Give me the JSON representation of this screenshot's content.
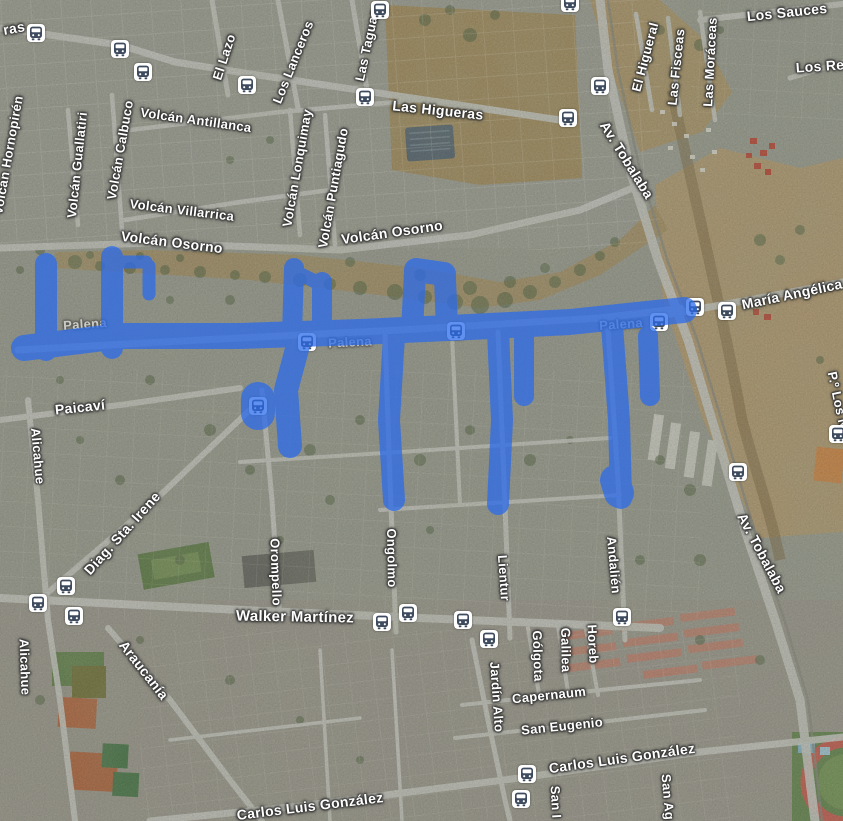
{
  "map": {
    "type": "satellite",
    "colors": {
      "route_overlay": "#2b6bec",
      "label_text": "#ffffff",
      "bus_icon_glyph": "#3e4b5e",
      "bus_icon_background": "#ffffff"
    },
    "street_labels": [
      {
        "text": "ras",
        "x": 14,
        "y": 28,
        "rot": -10,
        "size": 14,
        "faint": false
      },
      {
        "text": "El Lazo",
        "x": 224,
        "y": 57,
        "rot": -72,
        "size": 13,
        "faint": false
      },
      {
        "text": "Los Lanceros",
        "x": 293,
        "y": 62,
        "rot": -68,
        "size": 13,
        "faint": false
      },
      {
        "text": "Las Taguas",
        "x": 367,
        "y": 45,
        "rot": -78,
        "size": 13,
        "faint": false
      },
      {
        "text": "Las Higueras",
        "x": 438,
        "y": 110,
        "rot": 6,
        "size": 14,
        "faint": false
      },
      {
        "text": "Los Sauces",
        "x": 787,
        "y": 12,
        "rot": -6,
        "size": 14,
        "faint": false
      },
      {
        "text": "El Higueral",
        "x": 645,
        "y": 57,
        "rot": -75,
        "size": 13,
        "faint": false
      },
      {
        "text": "Las Fisceas",
        "x": 676,
        "y": 67,
        "rot": -84,
        "size": 13,
        "faint": false
      },
      {
        "text": "Las Moráceas",
        "x": 710,
        "y": 62,
        "rot": -87,
        "size": 13,
        "faint": false
      },
      {
        "text": "Los Re",
        "x": 820,
        "y": 66,
        "rot": -4,
        "size": 14,
        "faint": false
      },
      {
        "text": "Volcán Antillanca",
        "x": 196,
        "y": 120,
        "rot": 8,
        "size": 13,
        "faint": false
      },
      {
        "text": "Volcán Hornopirén",
        "x": 8,
        "y": 155,
        "rot": -80,
        "size": 13,
        "faint": false
      },
      {
        "text": "Volcán Guallatiri",
        "x": 77,
        "y": 165,
        "rot": -84,
        "size": 13,
        "faint": false
      },
      {
        "text": "Volcán Calbuco",
        "x": 120,
        "y": 150,
        "rot": -80,
        "size": 13,
        "faint": false
      },
      {
        "text": "Volcán Villarrica",
        "x": 182,
        "y": 210,
        "rot": 7,
        "size": 13,
        "faint": false
      },
      {
        "text": "Volcán Osorno",
        "x": 172,
        "y": 242,
        "rot": 7,
        "size": 14,
        "faint": false
      },
      {
        "text": "Volcán Osorno",
        "x": 392,
        "y": 232,
        "rot": -8,
        "size": 14,
        "faint": false
      },
      {
        "text": "Volcán Lonquimay",
        "x": 297,
        "y": 168,
        "rot": -80,
        "size": 13,
        "faint": false
      },
      {
        "text": "Volcán Puntiagudo",
        "x": 333,
        "y": 188,
        "rot": -80,
        "size": 13,
        "faint": false
      },
      {
        "text": "Av. Tobalaba",
        "x": 627,
        "y": 160,
        "rot": 58,
        "size": 14,
        "faint": false
      },
      {
        "text": "María Angélica",
        "x": 792,
        "y": 294,
        "rot": -12,
        "size": 14,
        "faint": false
      },
      {
        "text": "Palena",
        "x": 85,
        "y": 324,
        "rot": -4,
        "size": 13,
        "faint": true
      },
      {
        "text": "Palena",
        "x": 350,
        "y": 342,
        "rot": -3,
        "size": 13,
        "faint": true
      },
      {
        "text": "Palena",
        "x": 621,
        "y": 324,
        "rot": -4,
        "size": 13,
        "faint": true
      },
      {
        "text": "Paicaví",
        "x": 80,
        "y": 407,
        "rot": -6,
        "size": 14,
        "faint": false
      },
      {
        "text": "Alicahue",
        "x": 38,
        "y": 456,
        "rot": 85,
        "size": 13,
        "faint": false
      },
      {
        "text": "Diag. Sta. Irene",
        "x": 122,
        "y": 533,
        "rot": -48,
        "size": 14,
        "faint": false
      },
      {
        "text": "Orompello",
        "x": 276,
        "y": 572,
        "rot": 88,
        "size": 13,
        "faint": false
      },
      {
        "text": "Ongolmo",
        "x": 392,
        "y": 558,
        "rot": 89,
        "size": 13,
        "faint": false
      },
      {
        "text": "Lientur",
        "x": 504,
        "y": 578,
        "rot": 86,
        "size": 13,
        "faint": false
      },
      {
        "text": "Andalién",
        "x": 614,
        "y": 565,
        "rot": 85,
        "size": 13,
        "faint": false
      },
      {
        "text": "Av. Tobalaba",
        "x": 762,
        "y": 553,
        "rot": 62,
        "size": 14,
        "faint": false
      },
      {
        "text": "P.º Los N",
        "x": 838,
        "y": 400,
        "rot": 78,
        "size": 13,
        "faint": false
      },
      {
        "text": "Walker Martínez",
        "x": 295,
        "y": 617,
        "rot": 1,
        "size": 15,
        "faint": false
      },
      {
        "text": "Araucanía",
        "x": 144,
        "y": 670,
        "rot": 52,
        "size": 14,
        "faint": false
      },
      {
        "text": "Alicahue",
        "x": 25,
        "y": 667,
        "rot": 88,
        "size": 13,
        "faint": false
      },
      {
        "text": "Jardín Alto",
        "x": 497,
        "y": 697,
        "rot": 86,
        "size": 13,
        "faint": false
      },
      {
        "text": "Gólgota",
        "x": 538,
        "y": 656,
        "rot": 88,
        "size": 13,
        "faint": false
      },
      {
        "text": "Galilea",
        "x": 566,
        "y": 650,
        "rot": 89,
        "size": 13,
        "faint": false
      },
      {
        "text": "Horeb",
        "x": 593,
        "y": 644,
        "rot": 87,
        "size": 13,
        "faint": false
      },
      {
        "text": "Capernaum",
        "x": 549,
        "y": 695,
        "rot": -6,
        "size": 13,
        "faint": false
      },
      {
        "text": "San Eugenio",
        "x": 562,
        "y": 726,
        "rot": -6,
        "size": 13,
        "faint": false
      },
      {
        "text": "Carlos Luis González",
        "x": 622,
        "y": 758,
        "rot": -8,
        "size": 14,
        "faint": false
      },
      {
        "text": "Carlos Luis González",
        "x": 310,
        "y": 806,
        "rot": -7,
        "size": 14,
        "faint": false
      },
      {
        "text": "San I",
        "x": 556,
        "y": 802,
        "rot": 87,
        "size": 13,
        "faint": false
      },
      {
        "text": "San Ag",
        "x": 668,
        "y": 797,
        "rot": 85,
        "size": 13,
        "faint": false
      }
    ],
    "bus_stops": [
      {
        "x": 36,
        "y": 33,
        "under_route": false
      },
      {
        "x": 120,
        "y": 49,
        "under_route": false
      },
      {
        "x": 143,
        "y": 72,
        "under_route": false
      },
      {
        "x": 247,
        "y": 85,
        "under_route": false
      },
      {
        "x": 365,
        "y": 97,
        "under_route": false
      },
      {
        "x": 380,
        "y": 10,
        "under_route": false
      },
      {
        "x": 570,
        "y": 3,
        "under_route": false
      },
      {
        "x": 600,
        "y": 86,
        "under_route": false
      },
      {
        "x": 568,
        "y": 118,
        "under_route": false
      },
      {
        "x": 695,
        "y": 307,
        "under_route": false
      },
      {
        "x": 727,
        "y": 311,
        "under_route": false
      },
      {
        "x": 659,
        "y": 322,
        "under_route": true
      },
      {
        "x": 456,
        "y": 331,
        "under_route": true
      },
      {
        "x": 307,
        "y": 342,
        "under_route": true
      },
      {
        "x": 258,
        "y": 406,
        "under_route": true
      },
      {
        "x": 838,
        "y": 434,
        "under_route": false
      },
      {
        "x": 738,
        "y": 472,
        "under_route": false
      },
      {
        "x": 66,
        "y": 586,
        "under_route": false
      },
      {
        "x": 38,
        "y": 603,
        "under_route": false
      },
      {
        "x": 74,
        "y": 616,
        "under_route": false
      },
      {
        "x": 408,
        "y": 613,
        "under_route": false
      },
      {
        "x": 382,
        "y": 622,
        "under_route": false
      },
      {
        "x": 463,
        "y": 620,
        "under_route": false
      },
      {
        "x": 489,
        "y": 639,
        "under_route": false
      },
      {
        "x": 622,
        "y": 617,
        "under_route": false
      },
      {
        "x": 527,
        "y": 774,
        "under_route": false
      },
      {
        "x": 521,
        "y": 799,
        "under_route": false
      }
    ],
    "route_overlay": {
      "opacity": 0.74,
      "segments": [
        {
          "width": 26,
          "points": [
            [
              24,
              348
            ],
            [
              120,
              336
            ],
            [
              240,
              336
            ],
            [
              360,
              332
            ],
            [
              470,
              327
            ],
            [
              570,
              322
            ],
            [
              684,
              310
            ]
          ]
        },
        {
          "width": 22,
          "points": [
            [
              46,
              264
            ],
            [
              46,
              350
            ]
          ]
        },
        {
          "width": 22,
          "points": [
            [
              112,
              257
            ],
            [
              112,
              348
            ]
          ]
        },
        {
          "width": 13,
          "points": [
            [
              112,
              262
            ],
            [
              146,
              262
            ]
          ]
        },
        {
          "width": 13,
          "points": [
            [
              149,
              266
            ],
            [
              149,
              294
            ]
          ]
        },
        {
          "width": 20,
          "points": [
            [
              294,
              268
            ],
            [
              292,
              334
            ]
          ]
        },
        {
          "width": 20,
          "points": [
            [
              322,
              282
            ],
            [
              322,
              336
            ]
          ]
        },
        {
          "width": 14,
          "points": [
            [
              296,
              272
            ],
            [
              318,
              283
            ]
          ]
        },
        {
          "width": 22,
          "points": [
            [
              412,
              330
            ],
            [
              415,
              272
            ]
          ]
        },
        {
          "width": 22,
          "points": [
            [
              447,
              330
            ],
            [
              445,
              278
            ]
          ]
        },
        {
          "width": 24,
          "points": [
            [
              416,
              270
            ],
            [
              444,
              274
            ]
          ]
        },
        {
          "width": 24,
          "points": [
            [
              300,
              338
            ],
            [
              286,
              390
            ],
            [
              290,
              446
            ]
          ]
        },
        {
          "width": 34,
          "points": [
            [
              258,
              399
            ],
            [
              258,
              413
            ]
          ]
        },
        {
          "width": 22,
          "points": [
            [
              394,
              336
            ],
            [
              389,
              420
            ],
            [
              394,
              500
            ]
          ]
        },
        {
          "width": 22,
          "points": [
            [
              498,
              332
            ],
            [
              502,
              420
            ],
            [
              498,
              504
            ]
          ]
        },
        {
          "width": 20,
          "points": [
            [
              524,
              336
            ],
            [
              524,
              396
            ]
          ]
        },
        {
          "width": 22,
          "points": [
            [
              612,
              326
            ],
            [
              619,
              420
            ],
            [
              621,
              498
            ]
          ]
        },
        {
          "width": 30,
          "points": [
            [
              615,
              480
            ],
            [
              619,
              493
            ]
          ]
        },
        {
          "width": 20,
          "points": [
            [
              648,
              336
            ],
            [
              650,
              396
            ]
          ]
        }
      ]
    }
  }
}
